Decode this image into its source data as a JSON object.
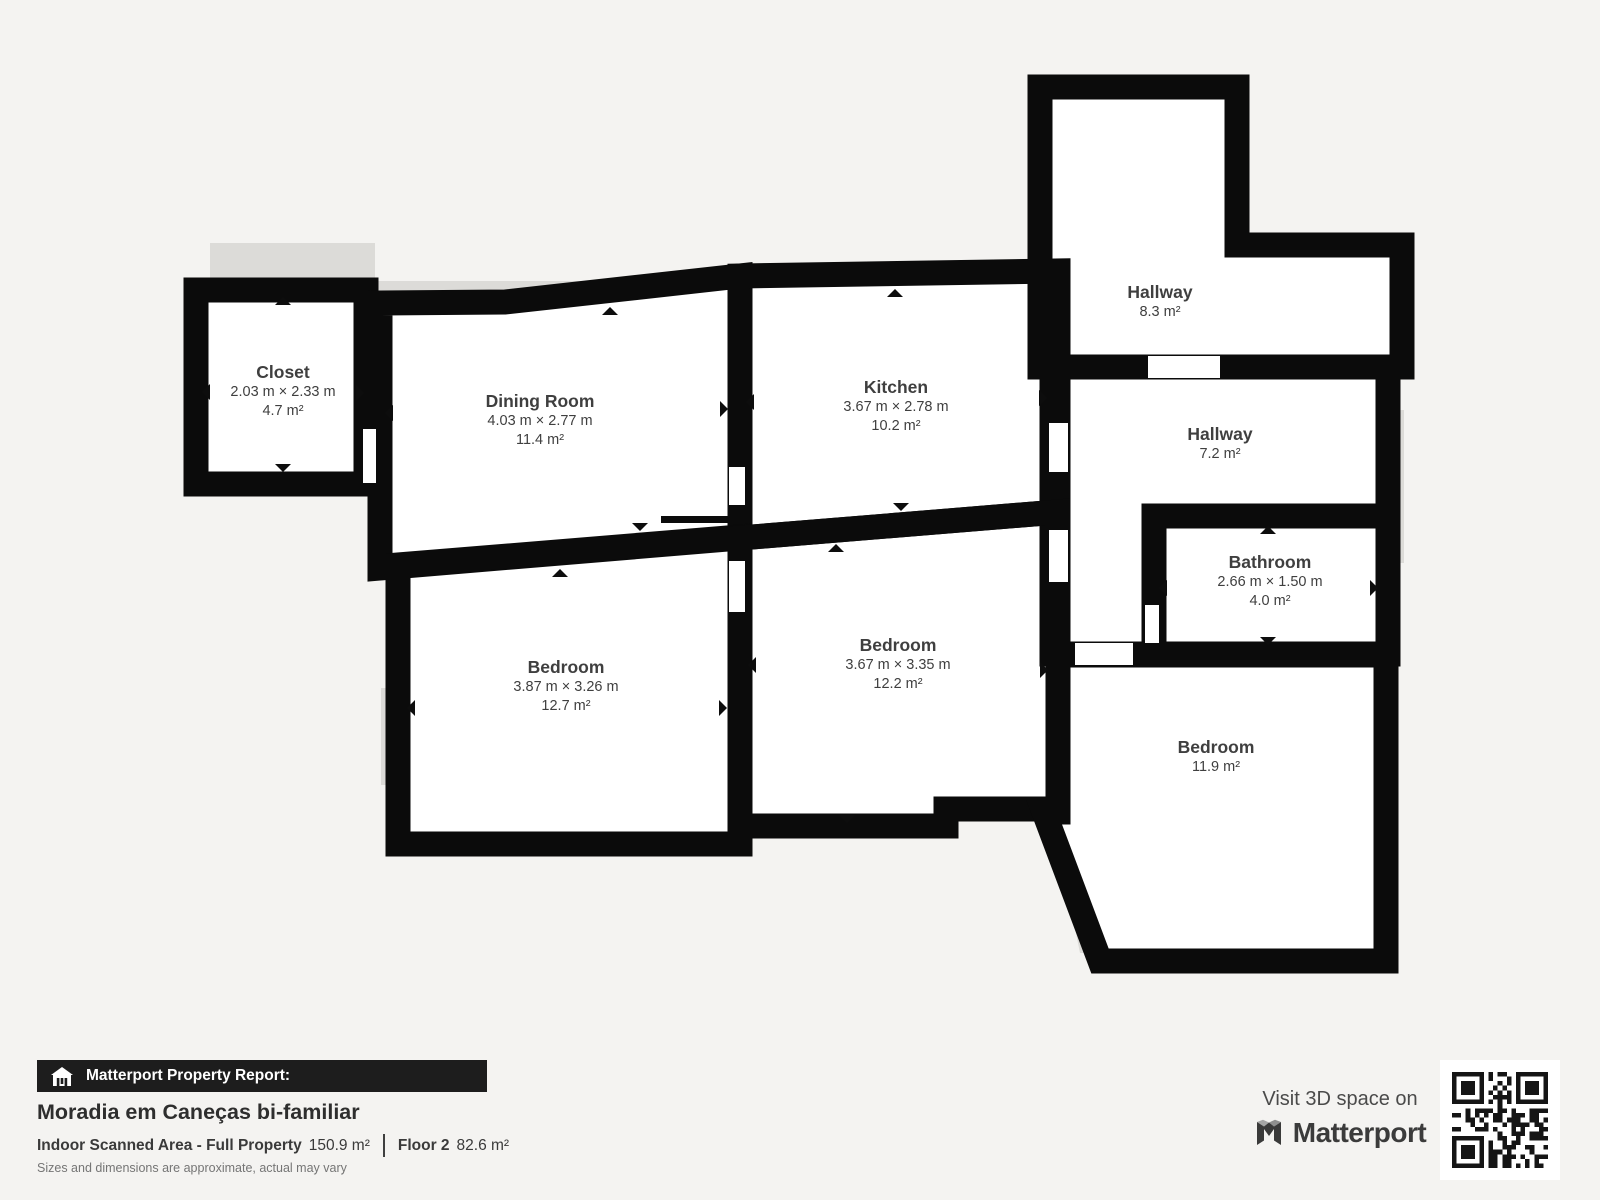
{
  "colors": {
    "background": "#f4f3f1",
    "wall": "#0b0b0b",
    "room_fill": "#ffffff",
    "shadow": "#dcdbd8",
    "label_text": "#3f3f3f",
    "footer_bar": "#1d1d1d"
  },
  "rooms": [
    {
      "id": "closet",
      "name": "Closet",
      "dimensions": "2.03 m × 2.33 m",
      "area": "4.7 m²"
    },
    {
      "id": "dining-room",
      "name": "Dining Room",
      "dimensions": "4.03 m × 2.77 m",
      "area": "11.4 m²"
    },
    {
      "id": "kitchen",
      "name": "Kitchen",
      "dimensions": "3.67 m × 2.78 m",
      "area": "10.2 m²"
    },
    {
      "id": "hallway-top",
      "name": "Hallway",
      "area": "8.3 m²"
    },
    {
      "id": "hallway-mid",
      "name": "Hallway",
      "area": "7.2 m²"
    },
    {
      "id": "bathroom",
      "name": "Bathroom",
      "dimensions": "2.66 m × 1.50 m",
      "area": "4.0 m²"
    },
    {
      "id": "bedroom-left",
      "name": "Bedroom",
      "dimensions": "3.87 m × 3.26 m",
      "area": "12.7 m²"
    },
    {
      "id": "bedroom-mid",
      "name": "Bedroom",
      "dimensions": "3.67 m × 3.35 m",
      "area": "12.2 m²"
    },
    {
      "id": "bedroom-right",
      "name": "Bedroom",
      "area": "11.9 m²"
    }
  ],
  "footer": {
    "report_label": "Matterport Property Report:",
    "property_title": "Moradia em Caneças bi-familiar",
    "scanned_area_label": "Indoor Scanned Area - Full Property",
    "scanned_area_value": "150.9 m²",
    "floor_label": "Floor 2",
    "floor_value": "82.6 m²",
    "disclaimer": "Sizes and dimensions are approximate, actual may vary"
  },
  "cta": {
    "visit_label": "Visit 3D space on",
    "brand": "Matterport"
  }
}
